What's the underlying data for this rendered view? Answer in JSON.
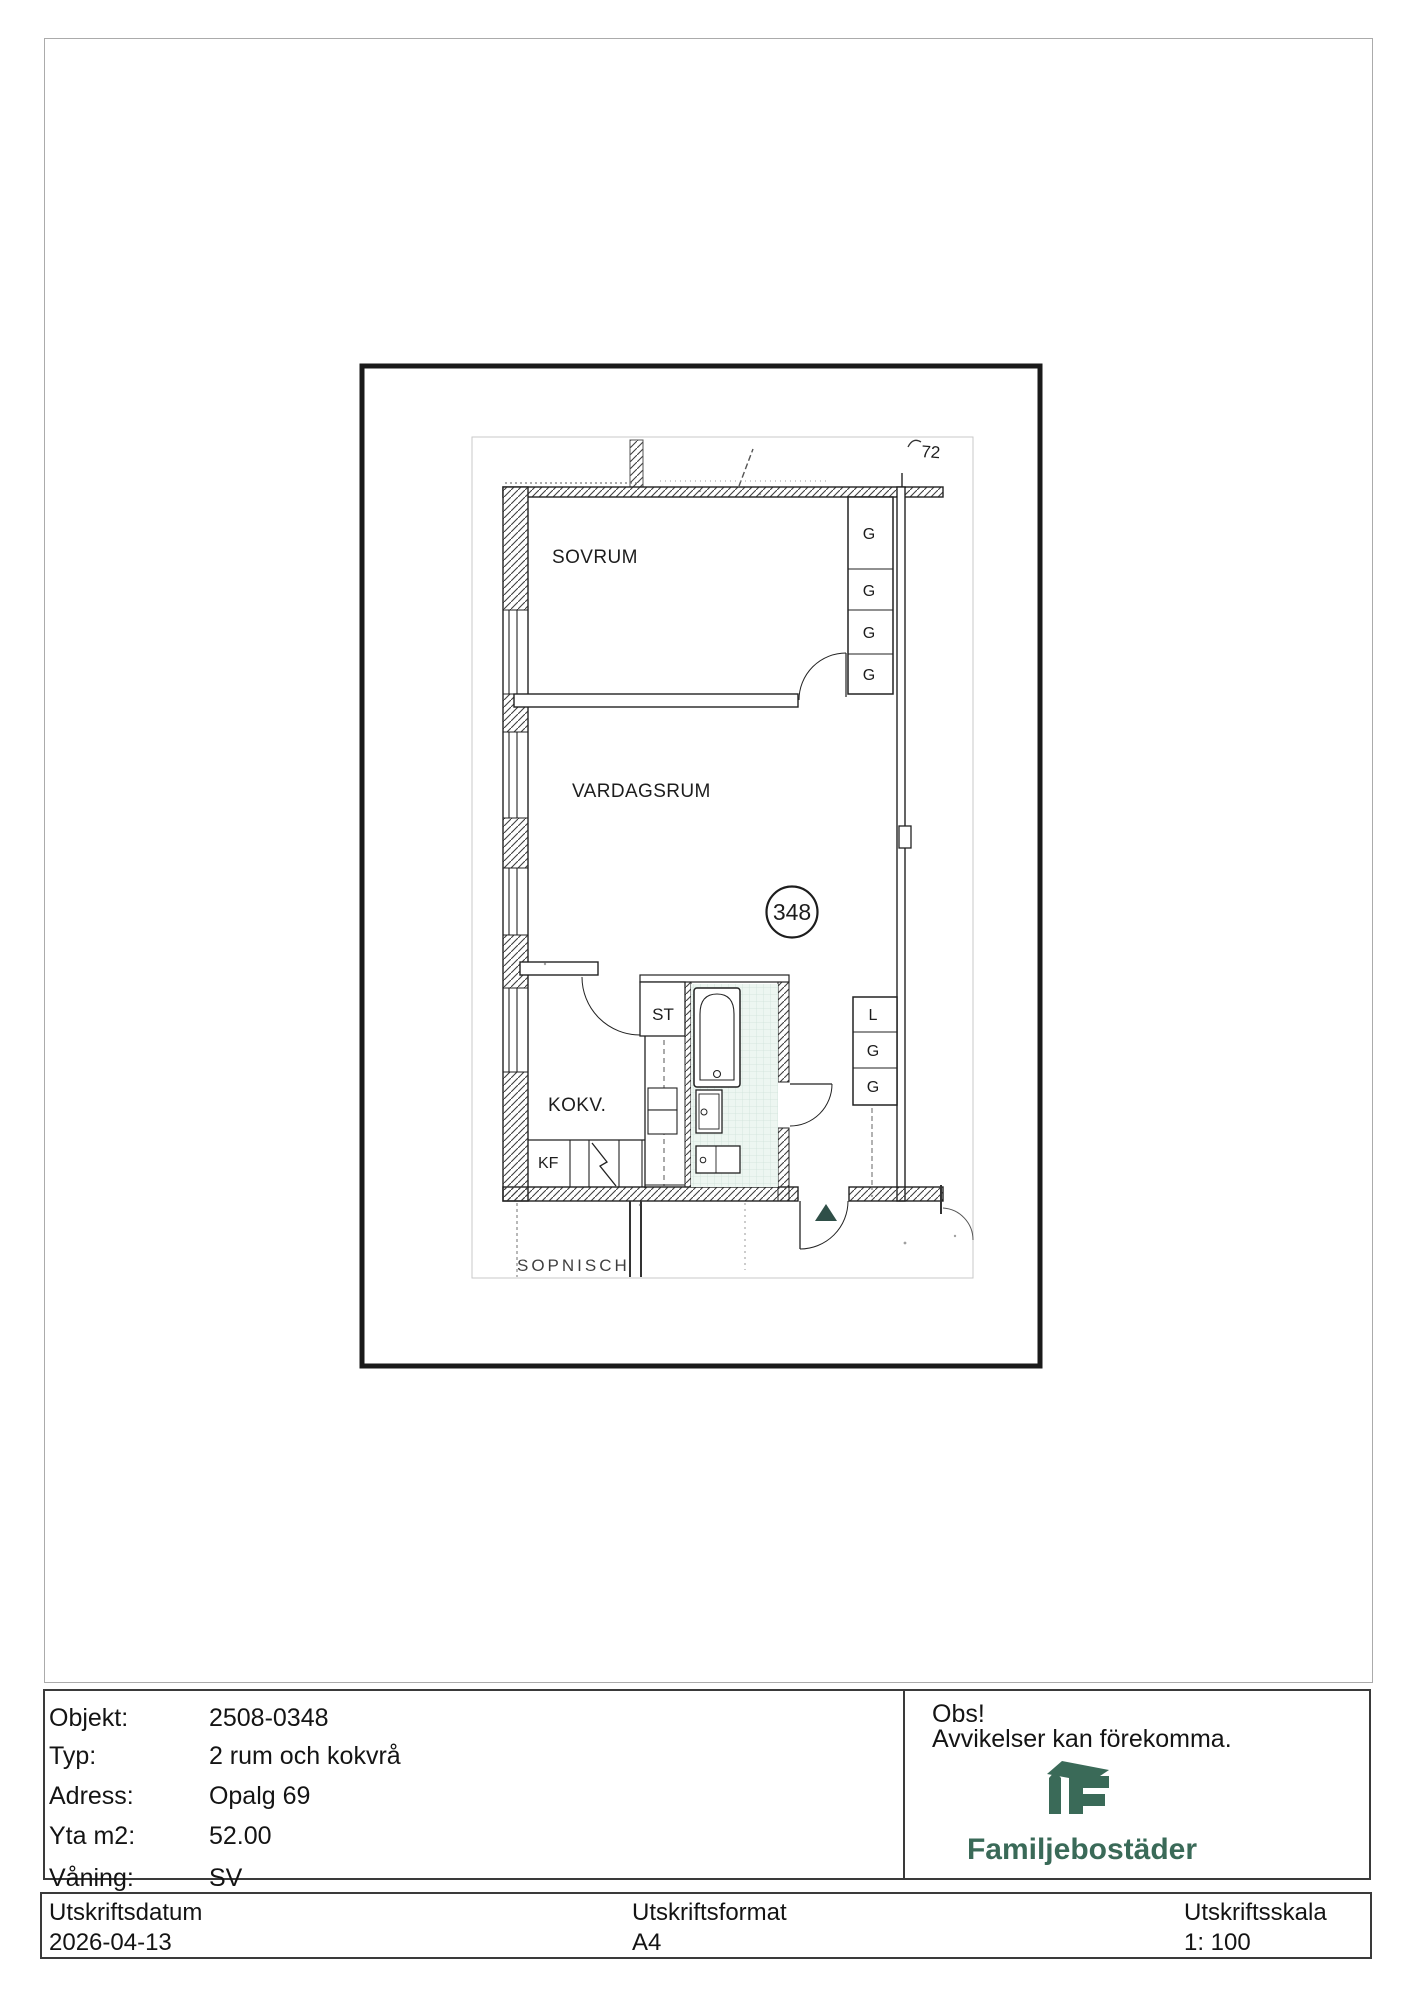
{
  "plan": {
    "corner_note": "72",
    "unit_number": "348",
    "rooms": {
      "sovrum": "SOVRUM",
      "vardagsrum": "VARDAGSRUM",
      "kokv": "KOKV.",
      "kf": "KF",
      "st": "ST",
      "sopnisch": "SOPNISCH"
    },
    "closets": {
      "g1": "G",
      "g2": "G",
      "g3": "G",
      "g4": "G",
      "l": "L",
      "g5": "G",
      "g6": "G"
    }
  },
  "meta": {
    "rows": [
      {
        "label": "Objekt:",
        "value": "2508-0348"
      },
      {
        "label": "Typ:",
        "value": "2 rum och kokvrå"
      },
      {
        "label": "Adress:",
        "value": "Opalg 69"
      },
      {
        "label": "Yta m2:",
        "value": "52.00"
      },
      {
        "label": "Våning:",
        "value": "SV"
      }
    ],
    "notice_title": "Obs!",
    "notice_body": "Avvikelser kan förekomma.",
    "brand_name": "Familjebostäder"
  },
  "footer": {
    "date_label": "Utskriftsdatum",
    "date_value": "2026-04-13",
    "format_label": "Utskriftsformat",
    "format_value": "A4",
    "scale_label": "Utskriftsskala",
    "scale_value": "1: 100"
  },
  "colors": {
    "brand_green": "#3a6a58",
    "entry_marker": "#2f4f48",
    "tile_fill": "#edf6f1",
    "tile_line": "#cfe3da"
  }
}
